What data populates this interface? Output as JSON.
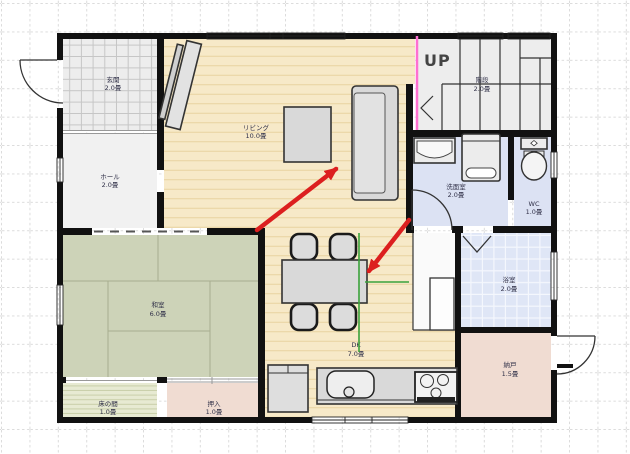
{
  "rooms": {
    "genkan": {
      "name": "玄関",
      "size": "2.0畳",
      "color": "#ededed"
    },
    "hall": {
      "name": "ホール",
      "size": "2.0畳",
      "color": "#f1f1f1"
    },
    "living": {
      "name": "リビング",
      "size": "10.0畳",
      "color": "#f7e9c8"
    },
    "washitsu": {
      "name": "和室",
      "size": "6.0畳",
      "color": "#cdd3b8"
    },
    "tokonoma": {
      "name": "床の間",
      "size": "1.0畳",
      "color": "#e7ead2"
    },
    "oshiire": {
      "name": "押入",
      "size": "1.0畳",
      "color": "#f0dcd2"
    },
    "dk": {
      "name": "DK",
      "size": "7.0畳",
      "color": "#f7e9c8"
    },
    "stairs": {
      "name": "階段",
      "size": "2.0畳",
      "up_label": "UP",
      "color": "#ededed"
    },
    "senmenshitsu": {
      "name": "洗面室",
      "size": "2.0畳",
      "color": "#dce2f3"
    },
    "wc": {
      "name": "WC",
      "size": "1.0畳",
      "color": "#dce2f3"
    },
    "bath": {
      "name": "浴室",
      "size": "2.0畳",
      "color": "#dfe6f6"
    },
    "nando": {
      "name": "納戸",
      "size": "1.5畳",
      "color": "#f0dcd2"
    },
    "corridor": {
      "name": "",
      "size": "",
      "color": "#fafafa"
    }
  },
  "colors": {
    "wall": "#111111",
    "wood_line": "#e8d3a0",
    "tile_line": "#c6c6c6",
    "bath_tile_line": "#f4f7fd",
    "tatami_line": "#a8ae8f",
    "tokonoma_line": "#c9cfa9",
    "furniture_fill": "#d9d9d9",
    "fixture_fill": "#ececec",
    "arrow_red": "#dc1f1f",
    "selection_green": "#3aa23a",
    "accent_magenta": "#ff6fd0",
    "grid": "#d8d8d8",
    "label_text": "#303048",
    "up_text": "#444444"
  }
}
